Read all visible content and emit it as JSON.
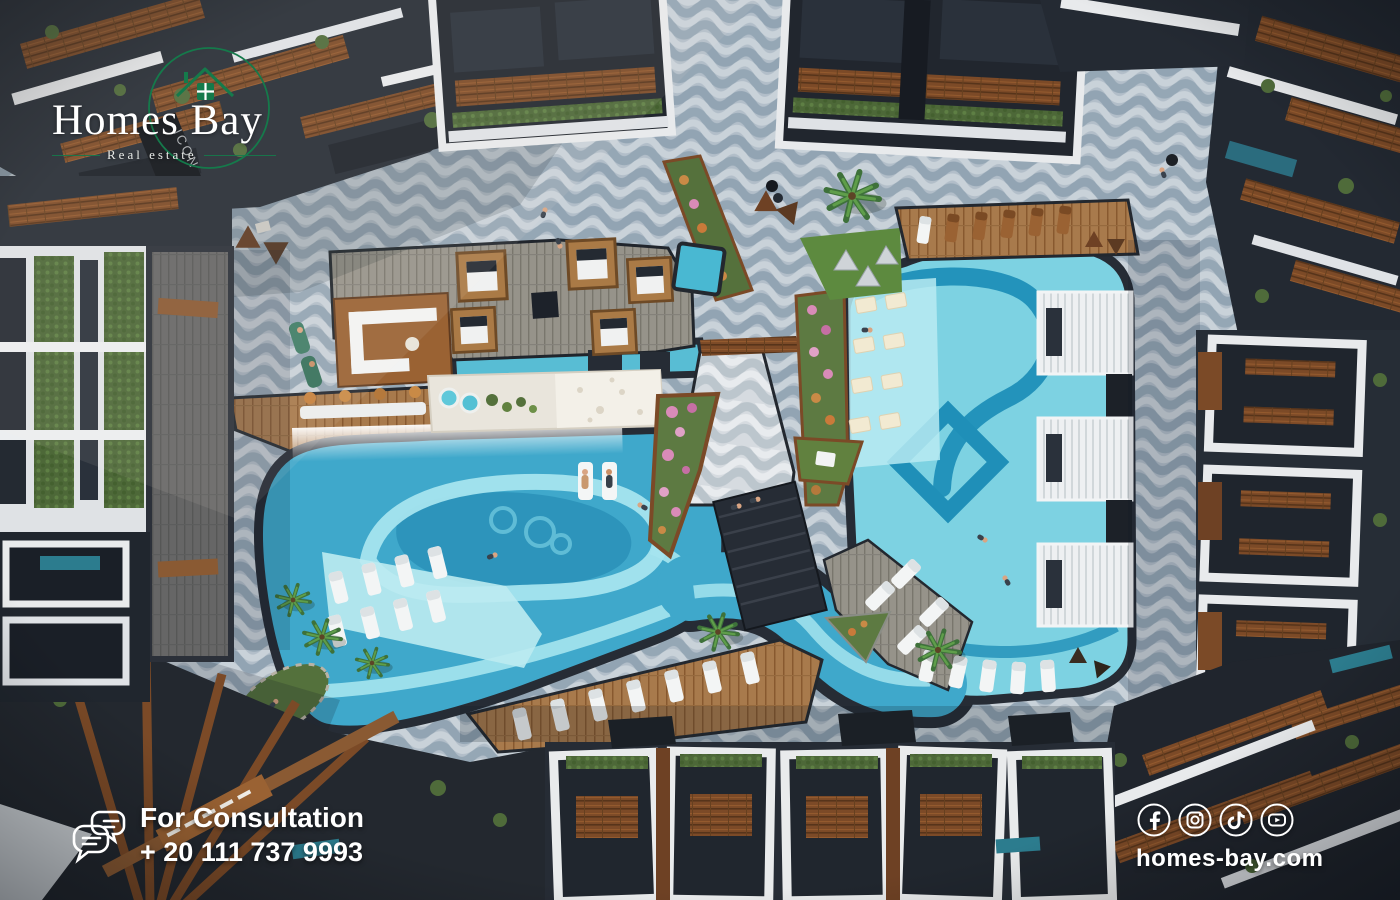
{
  "brand": {
    "name": "Homes Bay",
    "tagline": "Real estate"
  },
  "consultation": {
    "label": "For Consultation",
    "phone": "+ 20  111 737 9993"
  },
  "footer": {
    "website": "homes-bay.com",
    "social": [
      "facebook",
      "instagram",
      "tiktok",
      "youtube"
    ]
  },
  "scene": {
    "building_sign": "ICON"
  },
  "colors": {
    "brand_green": "#157a4b",
    "text_white": "#ffffff",
    "water_light": "#7dd2e2",
    "water_swirl": "#1f8fb8",
    "paving": "#b2bec9",
    "deck_charcoal": "#262c35",
    "wood": "#7c4a27"
  }
}
